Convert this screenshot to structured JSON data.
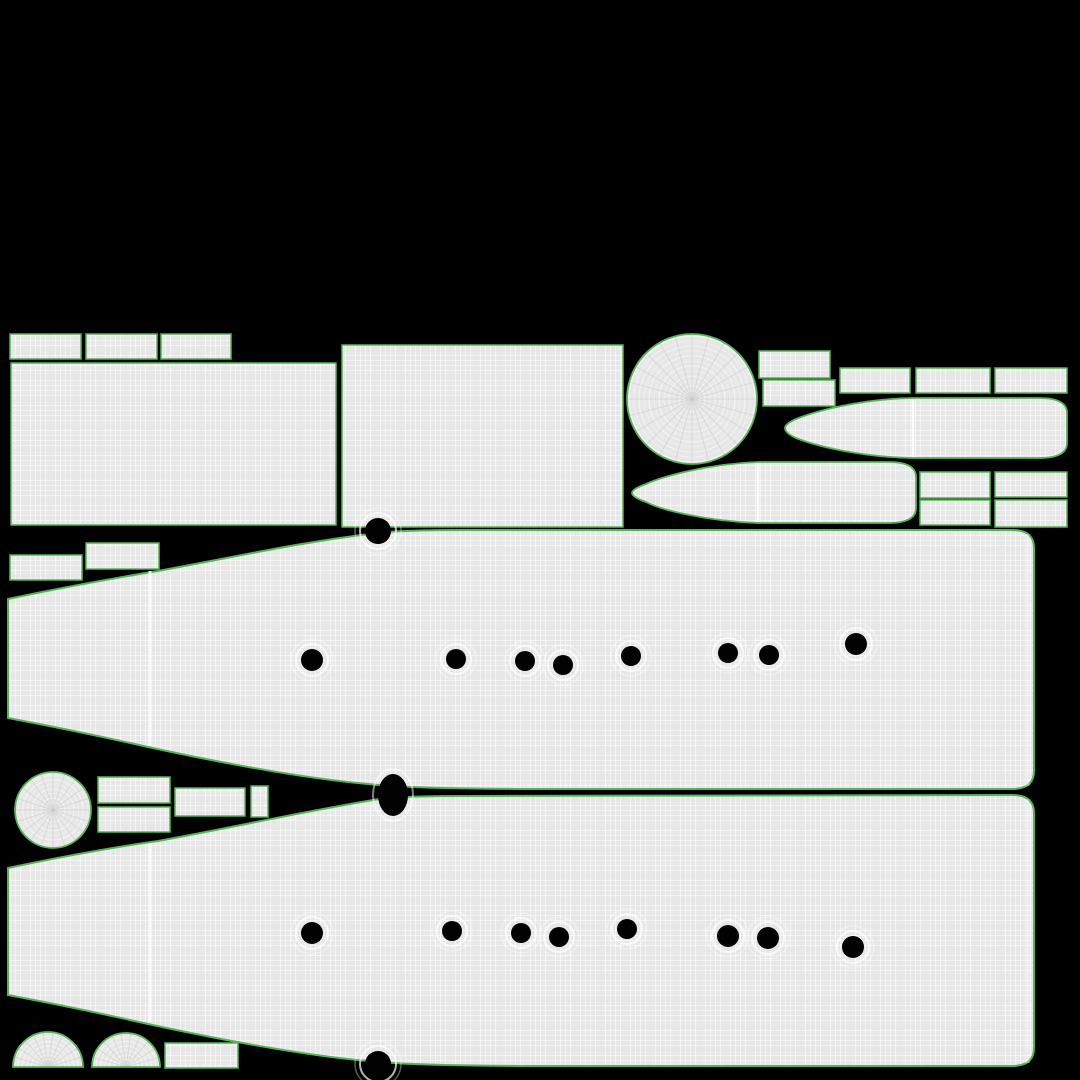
{
  "scene": "uv-wireframe-texture-layout",
  "canvas": {
    "width": 1080,
    "height": 1080
  },
  "colors": {
    "background": "#000000",
    "mesh_fill": "#e7e7e7",
    "grid_line_light": "rgba(255,255,255,0.55)",
    "grid_line_dark": "rgba(0,0,0,0.06)",
    "island_outline": "#57b357",
    "hole_fill": "#020202",
    "ring_stroke": "#ffffff",
    "spoke_stroke": "#c6c6c6",
    "seam_stroke": "#ffffff"
  },
  "islands": {
    "rects": [
      {
        "name": "uv-rect-top-1",
        "x": 10,
        "y": 334,
        "w": 71,
        "h": 25
      },
      {
        "name": "uv-rect-top-2",
        "x": 86,
        "y": 334,
        "w": 71,
        "h": 25
      },
      {
        "name": "uv-rect-top-3",
        "x": 161,
        "y": 334,
        "w": 70,
        "h": 25
      },
      {
        "name": "uv-panel-left",
        "x": 11,
        "y": 363,
        "w": 325,
        "h": 162
      },
      {
        "name": "uv-panel-middle",
        "x": 342,
        "y": 345,
        "w": 281,
        "h": 182
      },
      {
        "name": "uv-rect-right-1",
        "x": 759,
        "y": 351,
        "w": 71,
        "h": 27
      },
      {
        "name": "uv-rect-right-2",
        "x": 763,
        "y": 380,
        "w": 72,
        "h": 26
      },
      {
        "name": "uv-rect-right-3",
        "x": 840,
        "y": 368,
        "w": 70,
        "h": 25
      },
      {
        "name": "uv-rect-right-4",
        "x": 916,
        "y": 368,
        "w": 74,
        "h": 25
      },
      {
        "name": "uv-rect-right-5",
        "x": 995,
        "y": 368,
        "w": 72,
        "h": 25
      },
      {
        "name": "uv-rect-bottomright-1",
        "x": 920,
        "y": 472,
        "w": 70,
        "h": 26
      },
      {
        "name": "uv-rect-bottomright-2",
        "x": 995,
        "y": 472,
        "w": 72,
        "h": 25
      },
      {
        "name": "uv-rect-bottomright-3",
        "x": 920,
        "y": 500,
        "w": 70,
        "h": 25
      },
      {
        "name": "uv-rect-bottomright-4",
        "x": 995,
        "y": 500,
        "w": 72,
        "h": 27
      },
      {
        "name": "uv-rect-mid-left-1",
        "x": 10,
        "y": 555,
        "w": 72,
        "h": 25
      },
      {
        "name": "uv-rect-mid-left-2",
        "x": 86,
        "y": 543,
        "w": 73,
        "h": 26
      },
      {
        "name": "uv-rect-gap-1",
        "x": 98,
        "y": 777,
        "w": 72,
        "h": 26
      },
      {
        "name": "uv-rect-gap-2",
        "x": 98,
        "y": 807,
        "w": 72,
        "h": 25
      },
      {
        "name": "uv-rect-gap-3",
        "x": 175,
        "y": 788,
        "w": 70,
        "h": 28
      },
      {
        "name": "uv-rect-gap-small",
        "x": 251,
        "y": 786,
        "w": 17,
        "h": 31
      },
      {
        "name": "uv-rect-bottom-left",
        "x": 165,
        "y": 1043,
        "w": 73,
        "h": 25
      }
    ],
    "discs": [
      {
        "name": "uv-disc-large",
        "cx": 692,
        "cy": 399,
        "r": 65,
        "ring_step": 5,
        "spokes": 24
      },
      {
        "name": "uv-disc-small",
        "cx": 53,
        "cy": 810,
        "r": 38,
        "ring_step": 4.5,
        "spokes": 20
      }
    ],
    "domes": [
      {
        "name": "uv-dome-1",
        "cx": 48,
        "cy": 1067,
        "r": 35,
        "ring_step": 4.5,
        "spokes": 11
      },
      {
        "name": "uv-dome-2",
        "cx": 126,
        "cy": 1067,
        "r": 34,
        "ring_step": 4.5,
        "spokes": 11
      }
    ],
    "bullets": [
      {
        "name": "uv-bullet-upper",
        "path": "M 913 398 L 1039 398 Q 1067 398 1067 413 L 1067 443 Q 1067 458 1039 458 L 913 458 C 860 457 816 446 796 438 Q 785 433 785 428 Q 785 424 796 419 C 816 411 860 399 913 398 Z",
        "seam": {
          "x1": 913,
          "y1": 399,
          "x2": 913,
          "y2": 457
        }
      },
      {
        "name": "uv-bullet-lower",
        "path": "M 758 462 L 888 462 Q 916 462 916 477 L 916 508 Q 916 523 888 523 L 758 523 C 706 521 661 510 646 502 Q 632 497 632 493 Q 632 489 646 484 C 661 477 706 464 758 462 Z",
        "seam": {
          "x1": 758,
          "y1": 463,
          "x2": 758,
          "y2": 522
        }
      }
    ],
    "hulls": [
      {
        "name": "uv-hull-upper",
        "path": "M 8 599 C 60 588 115 578 158 571 C 240 556 300 542 385 532 Q 420 530 460 530 L 1012 530 Q 1034 530 1034 548 L 1034 771 Q 1034 789 1012 789 L 560 789 C 470 789 408 788 368 784 C 298 778 213 761 148 747 C 95 735 40 724 8 718 Z"
      },
      {
        "name": "uv-hull-lower",
        "path": "M 8 868 C 60 857 115 847 158 841 C 240 826 300 812 385 798 Q 420 796 460 796 L 1012 795 Q 1034 795 1034 813 L 1034 1048 Q 1034 1066 1012 1066 L 560 1066 C 470 1066 408 1065 368 1061 C 298 1055 213 1038 148 1024 C 95 1012 40 1001 8 995 Z"
      }
    ]
  },
  "seams": [
    {
      "name": "hull-upper-seam",
      "x1": 150,
      "y1": 571,
      "x2": 150,
      "y2": 745,
      "w": 3,
      "o": 0.85
    },
    {
      "name": "hull-lower-seam",
      "x1": 150,
      "y1": 843,
      "x2": 150,
      "y2": 1022,
      "w": 3,
      "o": 0.85
    },
    {
      "name": "hull-upper-edge-band",
      "x1": 1027,
      "y1": 534,
      "x2": 1027,
      "y2": 786,
      "w": 5,
      "o": 0.3
    },
    {
      "name": "hull-lower-edge-band",
      "x1": 1027,
      "y1": 799,
      "x2": 1027,
      "y2": 1063,
      "w": 5,
      "o": 0.3
    }
  ],
  "holes": {
    "upper_row": [
      [
        312,
        660,
        11
      ],
      [
        456,
        659,
        10
      ],
      [
        525,
        661,
        10
      ],
      [
        563,
        665,
        10
      ],
      [
        631,
        656,
        10
      ],
      [
        728,
        653,
        10
      ],
      [
        769,
        655,
        10
      ],
      [
        856,
        644,
        11
      ]
    ],
    "lower_row": [
      [
        312,
        933,
        11
      ],
      [
        452,
        931,
        10
      ],
      [
        521,
        933,
        10
      ],
      [
        559,
        937,
        10
      ],
      [
        627,
        929,
        10
      ],
      [
        728,
        936,
        11
      ],
      [
        768,
        938,
        11
      ],
      [
        853,
        947,
        11
      ]
    ],
    "edge_dots": [
      [
        378,
        531,
        13
      ],
      [
        378,
        1064,
        13
      ]
    ],
    "junction_ellipse": {
      "cx": 393,
      "cy": 795,
      "rx": 15,
      "ry": 21
    }
  }
}
